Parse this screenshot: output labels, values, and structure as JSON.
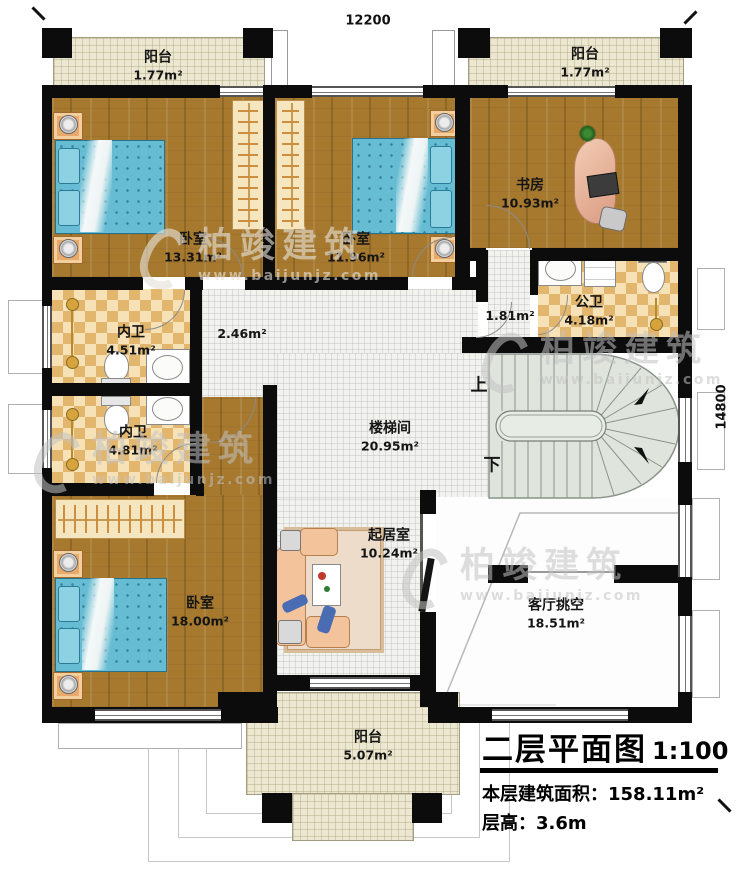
{
  "rooms": {
    "balcony_tl": {
      "name": "阳台",
      "area": "1.77m²"
    },
    "balcony_tr": {
      "name": "阳台",
      "area": "1.77m²"
    },
    "bedroom_left": {
      "name": "卧室",
      "area": "13.31m²"
    },
    "bedroom_mid": {
      "name": "卧室",
      "area": "11.96m²"
    },
    "study": {
      "name": "书房",
      "area": "10.93m²"
    },
    "public_bath": {
      "name": "公卫",
      "area": "4.18m²"
    },
    "bath_lobby": {
      "area": "1.81m²"
    },
    "ensuite_top": {
      "name": "内卫",
      "area": "4.51m²"
    },
    "hall_nook": {
      "area": "2.46m²"
    },
    "ensuite_bottom": {
      "name": "内卫",
      "area": "4.81m²"
    },
    "stair_hall": {
      "name": "楼梯间",
      "area": "20.95m²"
    },
    "bedroom_big": {
      "name": "卧室",
      "area": "18.00m²"
    },
    "sitting_room": {
      "name": "起居室",
      "area": "10.24m²"
    },
    "living_void": {
      "name": "客厅挑空",
      "area": "18.51m²"
    },
    "balcony_bottom": {
      "name": "阳台",
      "area": "5.07m²"
    }
  },
  "stairs": {
    "up": "上",
    "down": "下"
  },
  "dimensions": {
    "width": "12200",
    "height": "14800"
  },
  "title_block": {
    "title": "二层平面图",
    "scale": "1:100",
    "area_label": "本层建筑面积：",
    "area_value": "158.11m²",
    "floor_height_label": "层高：",
    "floor_height_value": "3.6m"
  },
  "watermark": {
    "brand": "柏竣建筑",
    "website": "www.baijunjz.com"
  },
  "colors": {
    "wall": "#0c0c0c",
    "wood_floor": "#a6792f",
    "bath_tile": "#e3b66e",
    "balcony": "#ece7d1",
    "stair": "#dfe5dc"
  }
}
